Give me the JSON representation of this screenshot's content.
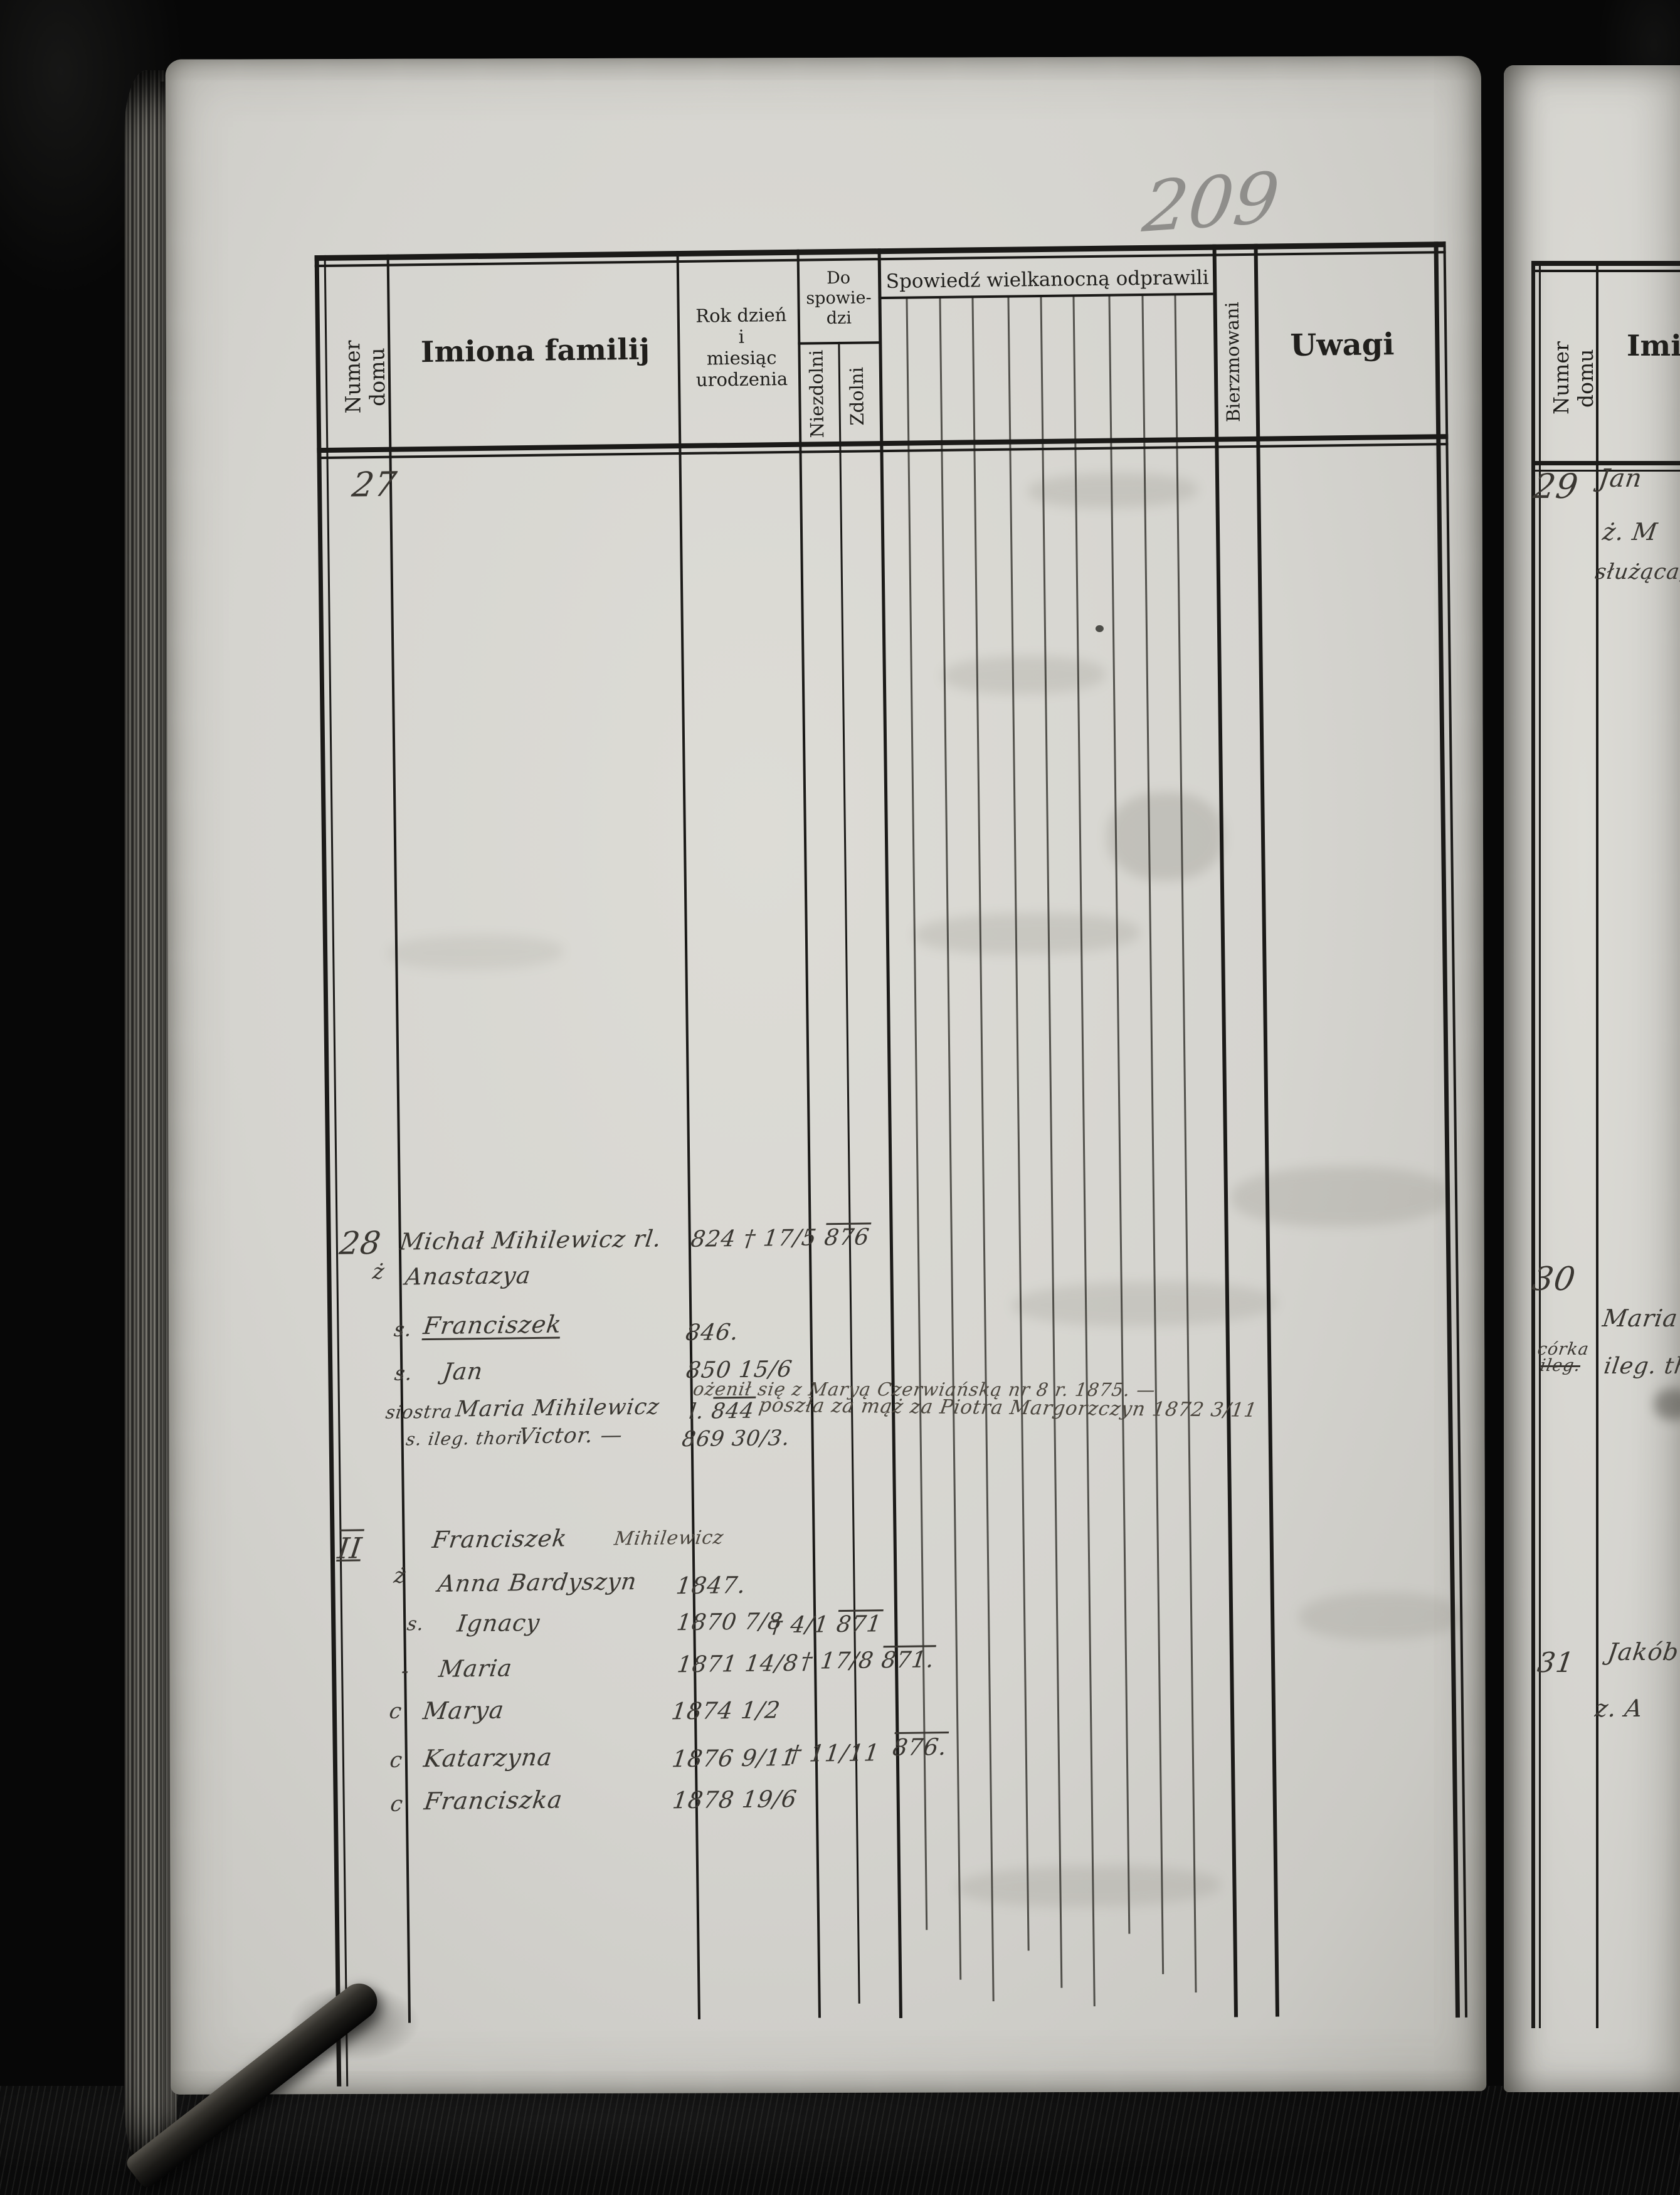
{
  "page_number": "209",
  "colors": {
    "paper": "#d5d4cf",
    "printed_ink": "#201f1c",
    "handwriting_ink": "#3a3732",
    "pencil": "#8f8e8b",
    "leather": "#0a0a0a"
  },
  "main_page": {
    "header": {
      "numer_domu": "Numer domu",
      "imiona_familij": "Imiona familij",
      "rok_lines": [
        "Rok dzień",
        "i",
        "miesiąc",
        "urodzenia"
      ],
      "do_spowiedzi_lines": [
        "Do",
        "spowie-",
        "dzi"
      ],
      "niezdolni": "Niezdolni",
      "zdolni": "Zdolni",
      "spowiedz_wielkanocna": "Spowiedź wielkanocną odprawili",
      "bierzmowani": "Bierzmowani",
      "uwagi": "Uwagi"
    },
    "entry27": {
      "number": "27"
    },
    "entry28": {
      "number": "28",
      "head_name": "Michał Mihilewicz rl.",
      "head_birth": "824 † 17/5",
      "head_birth_over": "876",
      "wife_prefix": "ż",
      "wife_name": "Anastazya",
      "son1_prefix": "s.",
      "son1_name": "Franciszek",
      "son1_birth": "846.",
      "son2_prefix": "s.",
      "son2_name": "Jan",
      "son2_birth": "850 15/6",
      "son2_note": "ożenił się z Maryą Czerwiańską nr 8 r. 1875. —",
      "sister_prefix": "siostra",
      "sister_name": "Maria Mihilewicz",
      "sister_birth_prefix": "l.",
      "sister_birth_over": "844",
      "sister_note": "poszła za mąż za Piotra Margorzczyn 1872 3/11",
      "son3_prefix": "s. ileg. thori.",
      "son3_name": "Victor. —",
      "son3_birth": "869 30/3."
    },
    "entryII": {
      "number": "II",
      "head_name": "Franciszek",
      "head_surname": "Mihilewicz",
      "wife_prefix": "ż",
      "wife_name": "Anna Bardyszyn",
      "wife_birth": "1847.",
      "child1_prefix": "s.",
      "child1_name": "Ignacy",
      "child1_birth": "1870 7/8",
      "child1_death": "† 4/1",
      "child1_death_over": "871",
      "child2_prefix": "-",
      "child2_name": "Maria",
      "child2_birth": "1871 14/8",
      "child2_death": "† 17/8",
      "child2_death_over": "871.",
      "child3_prefix": "c",
      "child3_name": "Marya",
      "child3_birth": "1874 1/2",
      "child4_prefix": "c",
      "child4_name": "Katarzyna",
      "child4_birth": "1876 9/11",
      "child4_death": "† 11/11",
      "child4_conf_over": "876.",
      "child5_prefix": "c",
      "child5_name": "Franciszka",
      "child5_birth": "1878 19/6"
    }
  },
  "right_page": {
    "header": {
      "numer_domu": "Numer domu",
      "imiona_partial": "Imi"
    },
    "entry29": {
      "number": "29",
      "line1": "Jan",
      "line2": "ż. M",
      "line3": "służąca,"
    },
    "entry30": {
      "number": "30",
      "sub_label": "córka",
      "sub_struck": "ileg.",
      "line1": "Maria",
      "line2": "ileg. ther"
    },
    "entry31": {
      "number": "31",
      "line1": "Jakób",
      "line2": "z. A"
    }
  }
}
